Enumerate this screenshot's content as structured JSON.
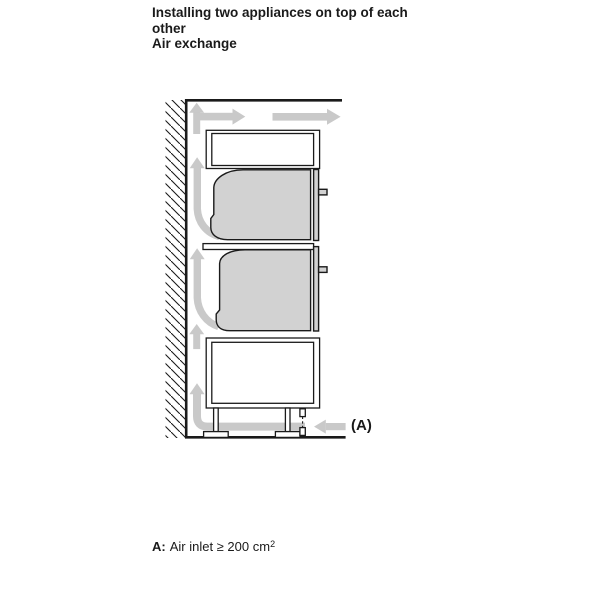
{
  "header": {
    "title_line1": "Installing two appliances on top of each",
    "title_line2": "other",
    "subtitle": "Air exchange"
  },
  "diagram": {
    "callout_label": "(A)"
  },
  "legend": {
    "term": "A:",
    "definition": "Air inlet ≥ 200 cm",
    "superscript": "2"
  },
  "colors": {
    "outline": "#1a1a1a",
    "arrow": "#c9c9c9",
    "appliance_fill": "#d2d2d2",
    "background": "#ffffff"
  }
}
